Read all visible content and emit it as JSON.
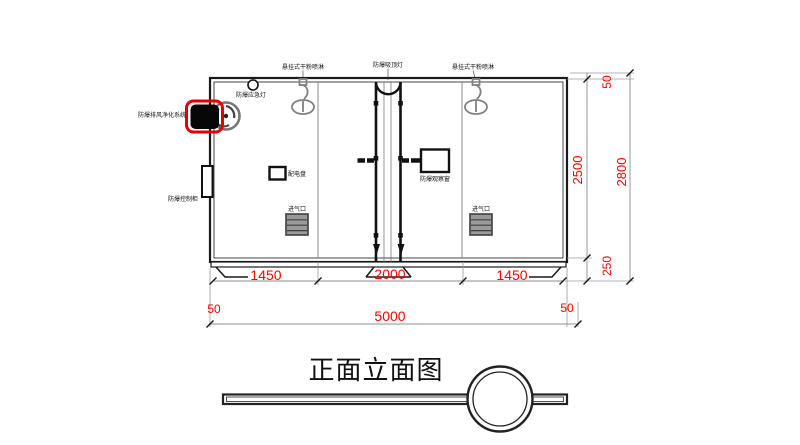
{
  "title": "正面立面图",
  "components": {
    "spray_left": "悬挂式干粉喷淋",
    "ceiling_lamp": "防爆吸顶灯",
    "spray_right": "悬挂式干粉喷淋",
    "emergency_lamp": "防爆应急灯",
    "exhaust_purifier": "防爆排风净化系统",
    "control_cabinet": "防爆控制柜",
    "power_panel": "配电盘",
    "observation_window": "防爆观察窗",
    "air_inlet_left": "进气口",
    "air_inlet_right": "进气口"
  },
  "dimensions": {
    "bottom_segments": [
      "1450",
      "2000",
      "1450"
    ],
    "overall_width": "5000",
    "width_margin_left": "50",
    "width_margin_right": "50",
    "cabin_height": "2500",
    "overall_height": "2800",
    "roof_offset": "50",
    "base_height": "250"
  },
  "colors": {
    "dimension_text": "#ff0000",
    "line": "#1a1a1a",
    "equipment_gray": "#808080",
    "highlight_red": "#e60000"
  }
}
